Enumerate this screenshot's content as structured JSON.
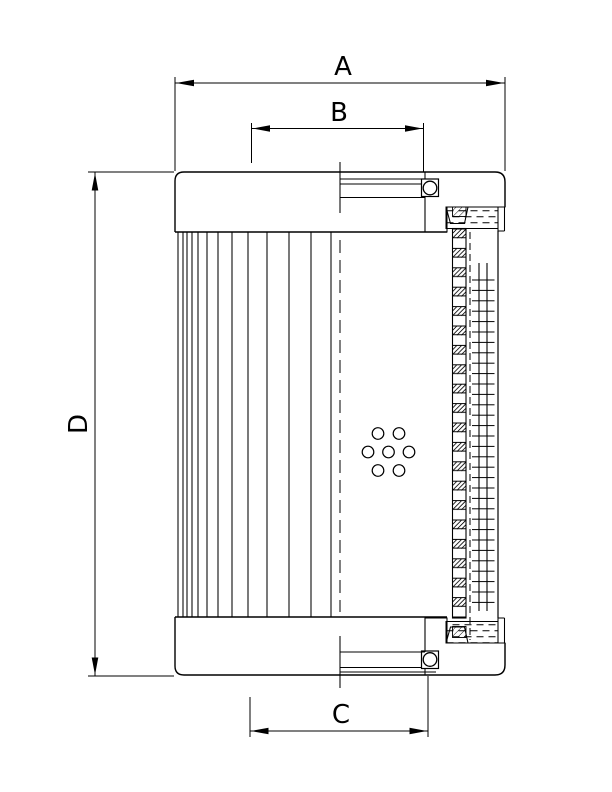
{
  "dimensions": {
    "a": {
      "label": "A"
    },
    "b": {
      "label": "B"
    },
    "c": {
      "label": "C"
    },
    "d": {
      "label": "D"
    }
  },
  "colors": {
    "line": "#000000",
    "background": "#ffffff"
  }
}
